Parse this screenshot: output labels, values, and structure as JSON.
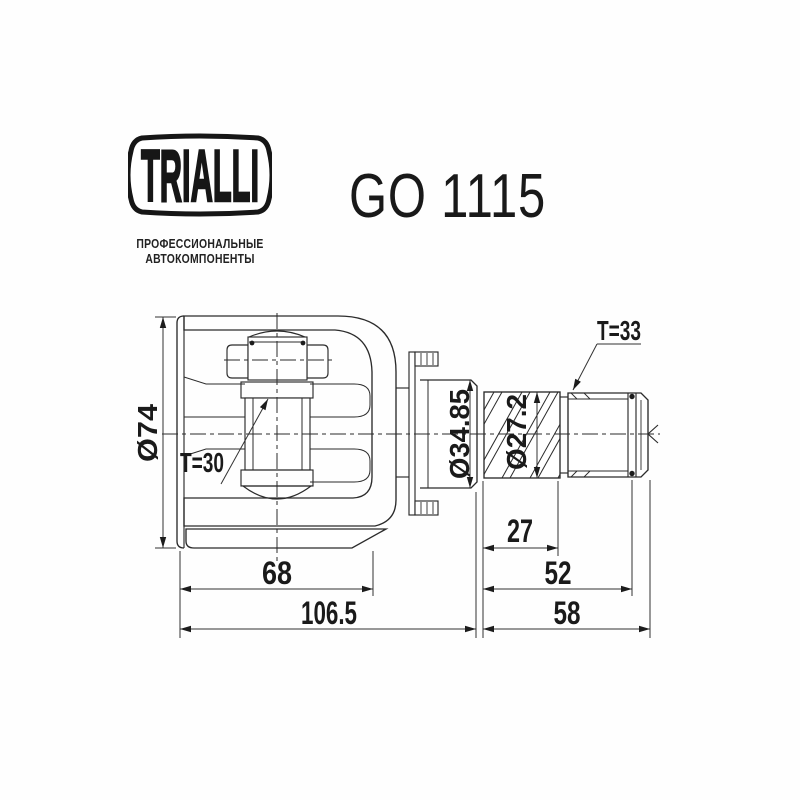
{
  "header": {
    "logo_text": "TRIALLI",
    "tagline_line1": "ПРОФЕССИОНАЛЬНЫЕ",
    "tagline_line2": "АВТОКОМПОНЕНТЫ",
    "part_number": "GO 1115"
  },
  "drawing": {
    "labels": {
      "housing_outer_diameter": "Ø74",
      "inner_spline_teeth": "T=30",
      "outer_spline_teeth": "T=33",
      "seal_seat_diameter": "Ø34.85",
      "shaft_spline_diameter": "Ø27.2"
    },
    "dimensions": {
      "housing_length": "68",
      "overall_length_left": "106.5",
      "spline_section_length": "27",
      "groove_position": "52",
      "shaft_length": "58"
    },
    "colors": {
      "line": "#2b2b2b",
      "text": "#1a1a1a",
      "background": "#ffffff"
    }
  }
}
